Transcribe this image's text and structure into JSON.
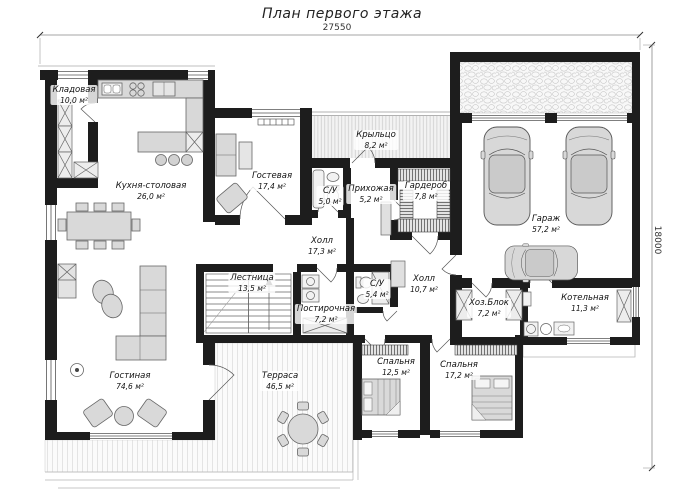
{
  "title": "План первого этажа",
  "dimension_top": "27550",
  "dimension_right": "18000",
  "area_unit": "м²",
  "colors": {
    "wall": "#1d1d1d",
    "furniture": "#d8d8d8",
    "hatch": "#c9c9c9",
    "text": "#111111"
  },
  "rooms": [
    {
      "name": "Кладовая",
      "area": "10,0",
      "x": 74,
      "y": 95
    },
    {
      "name": "Кухня-столовая",
      "area": "26,0",
      "x": 151,
      "y": 191
    },
    {
      "name": "Гостевая",
      "area": "17,4",
      "x": 272,
      "y": 181
    },
    {
      "name": "Крыльцо",
      "area": "8,2",
      "x": 376,
      "y": 140
    },
    {
      "name": "С/У",
      "area": "5,0",
      "x": 330,
      "y": 196
    },
    {
      "name": "Прихожая",
      "area": "5,2",
      "x": 371,
      "y": 194
    },
    {
      "name": "Гардероб",
      "area": "7,8",
      "x": 426,
      "y": 191
    },
    {
      "name": "Холл",
      "area": "17,3",
      "x": 322,
      "y": 246
    },
    {
      "name": "Гараж",
      "area": "57,2",
      "x": 546,
      "y": 224
    },
    {
      "name": "Лестница",
      "area": "13,5",
      "x": 252,
      "y": 283
    },
    {
      "name": "Постирочная",
      "area": "7,2",
      "x": 326,
      "y": 314
    },
    {
      "name": "С/У",
      "area": "5,4",
      "x": 377,
      "y": 289
    },
    {
      "name": "Холл",
      "area": "10,7",
      "x": 424,
      "y": 284
    },
    {
      "name": "Хоз.Блок",
      "area": "7,2",
      "x": 489,
      "y": 308
    },
    {
      "name": "Котельная",
      "area": "11,3",
      "x": 585,
      "y": 303
    },
    {
      "name": "Гостиная",
      "area": "74,6",
      "x": 130,
      "y": 381
    },
    {
      "name": "Терраса",
      "area": "46,5",
      "x": 280,
      "y": 381
    },
    {
      "name": "Спальня",
      "area": "12,5",
      "x": 396,
      "y": 367
    },
    {
      "name": "Спальня",
      "area": "17,2",
      "x": 459,
      "y": 370
    }
  ]
}
